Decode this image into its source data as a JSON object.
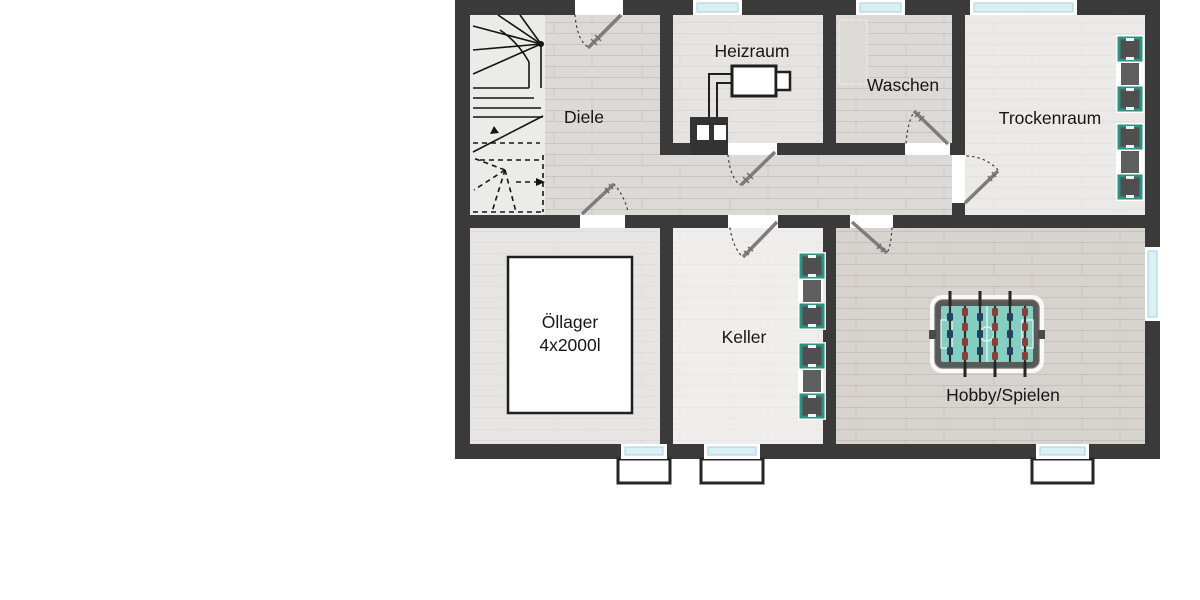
{
  "floorplan": {
    "kind": "basement-floor-plan",
    "rooms": {
      "diele": {
        "label": "Diele"
      },
      "heizraum": {
        "label": "Heizraum"
      },
      "waschen": {
        "label": "Waschen"
      },
      "trockenraum": {
        "label": "Trockenraum"
      },
      "oellager": {
        "label_line1": "Öllager",
        "label_line2": "4x2000l"
      },
      "keller": {
        "label": "Keller"
      },
      "hobby": {
        "label": "Hobby/Spielen"
      }
    },
    "icons": {
      "staircase": "winder-staircase-with-direction-arrows",
      "furnace": "boiler-with-flue-pipe",
      "chimney": "chimney-block-with-two-flues",
      "foosball_table": "foosball-table-top-view",
      "appliance_squares": "teal-framed-appliance-icons",
      "doors": "swing-door-with-dashed-arc",
      "windows": "glazed-window-strip",
      "light_wells": "basement-light-well"
    },
    "colors": {
      "background": "#ffffff",
      "wall": "#3a3a3a",
      "floor_wood": "#dcdad6",
      "floor_wood_dark": "#d7d3ce",
      "floor_stone": "#e7e6e4",
      "glazing": "#d9f0f4",
      "appliance_teal": "#2d9184",
      "foosball_field": "#85cfc2",
      "player_blue": "#24415f",
      "player_red": "#8a4038",
      "door_leaf": "#7d7d7d"
    }
  }
}
